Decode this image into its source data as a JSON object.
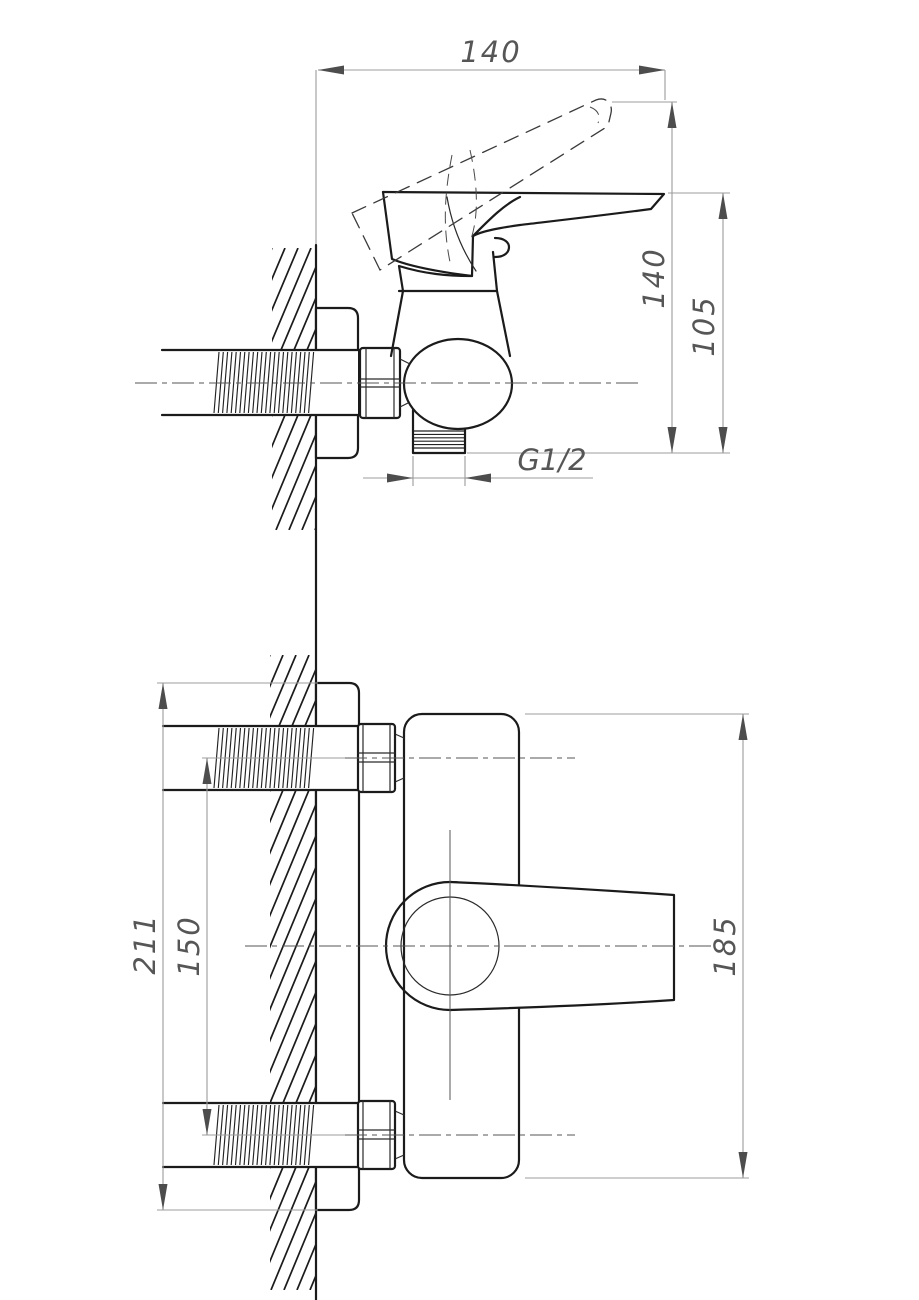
{
  "drawing": {
    "type": "technical-dimension-drawing",
    "subject": "wall-mounted single-lever shower mixer",
    "colors": {
      "background": "#ffffff",
      "object_line": "#1b1b1b",
      "dimension_line": "#9c9c9c",
      "arrow": "#4d4d4d",
      "text": "#565656"
    },
    "side_view": {
      "dim_width": "140",
      "dim_lift_height": "140",
      "dim_body_height": "105",
      "dim_outlet_thread": "G1/2"
    },
    "front_view": {
      "dim_overall_height": "211",
      "dim_port_spacing": "150",
      "dim_body_height": "185"
    }
  }
}
